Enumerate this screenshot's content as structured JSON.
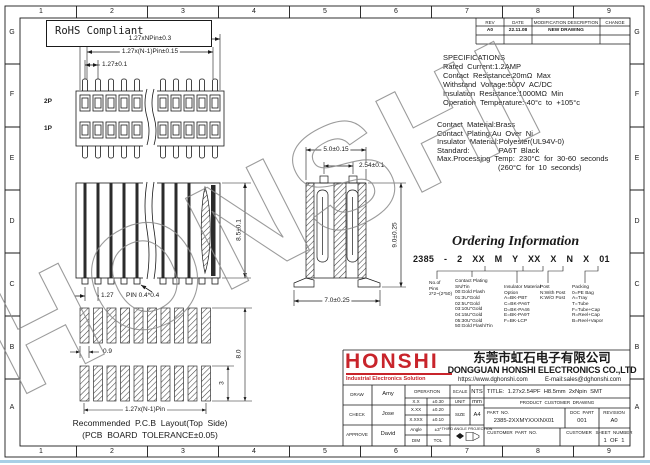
{
  "watermark": "HONSHI",
  "rohs": "RoHS Compliant",
  "grid": {
    "cols": [
      "1",
      "2",
      "3",
      "4",
      "5",
      "6",
      "7",
      "8",
      "9"
    ],
    "rows": [
      "G",
      "F",
      "E",
      "D",
      "C",
      "B",
      "A"
    ]
  },
  "rev": {
    "h": [
      "REV",
      "DATE",
      "MODIFICATION DESCRIPTION",
      "CHANGE"
    ],
    "r": [
      "A0",
      "22.11.08",
      "NEW DRAWING"
    ]
  },
  "spec": {
    "title": "SPECIFICATIONS",
    "lines": [
      "Rated  Current:1.2AMP",
      "Contact  Resistance:20mΩ  Max",
      "Withstand  Voltage:500V  AC/DC",
      "Insulation  Resistance:1000MΩ  Min",
      "Operation  Temperature:-40°c  to  +105°c"
    ]
  },
  "mat": {
    "lines": [
      "Contact  Material:Brass",
      "Contact  Plating:Au  Over  Ni",
      "Insulator  Material:Polyester(UL94V-0)",
      "Standard:              PA6T  Black",
      "Max.Processing  Temp:  230°C  for  30-60  seconds",
      "(260°C  for  10  seconds)"
    ]
  },
  "ord": {
    "title": "Ordering Information",
    "code": "2385 - 2 XX M Y XX X N X 01",
    "pins": "No.of\nPins\n2*2~(2*50)",
    "plating": "Contact Plating\nSN/Tin\n00:Gold Flash\n01:3U\"Gold\n02:5U\"Gold\n03:10U\"Gold\n04:15U\"Gold\n05:30U\"Gold\n50:Gold Flash/Tin",
    "insulator": "Insulator Material\nOption\nA=BK-PBT\nC=BK-PA6T\nD=BK-PA46\nE=BK-PA9T\nF=BK-LCP",
    "post": "Post\nN:With Post\nK:W/O Post",
    "packing": "Packing\n0=PE Bag\nA=Tray\nT=Tube\nF=Tube+Cap\nR=Reel+Cap\nB=Reel+Vapor"
  },
  "dims": {
    "front_overall": "1.27xNPin±0.3",
    "front_n1": "1.27x(N-1)Pin±0.15",
    "front_pitch": "1.27±0.1",
    "row2": "2P",
    "row1": "1P",
    "height": "8.5±0.1",
    "pitch127": "1.27",
    "pin_size": "PIN 0.4*0.4",
    "sec_width": "5.0±0.15",
    "sec_pitch": "2.54±0.1",
    "sec_height": "9.0±0.25",
    "sec_foot": "7.0±0.25",
    "pad_w": "0.9",
    "pad_span": "8.0",
    "pad_h": "3",
    "pcb_pitch": "1.27x(N-1)Pin",
    "pcb_caption1": "Recommended  P.C.B  Layout(Top  Side)",
    "pcb_caption2": "(PCB  BOARD  TOLERANCE±0.05)"
  },
  "co": {
    "logo": "HONSHI",
    "tagline": "Industrial Electronics Solution",
    "name_cn": "东莞市虹石电子有限公司",
    "name_en": "DONGGUAN HONSHI ELECTRONICS CO.,LTD",
    "web": "https://www.dghonshi.com",
    "email": "E-mail:sales@dghonshi.com"
  },
  "tb": {
    "draw_label": "DRAW",
    "draw": "Amy",
    "check_label": "CHECK",
    "check": "Jose",
    "approve_label": "APPROVE",
    "approve": "David",
    "operation_label": "OPERATION",
    "tol": [
      {
        "k": "X.X",
        "v": "±0.30"
      },
      {
        "k": "X.XX",
        "v": "±0.20"
      },
      {
        "k": "X.XXX",
        "v": "±0.10"
      },
      {
        "k": "Angle",
        "v": "±3°"
      },
      {
        "k": "DIM",
        "v": "TOL"
      }
    ],
    "scale_label": "SCALE",
    "scale": "NTS",
    "unit_label": "UNIT",
    "unit": "mm",
    "size_label": "SIZE",
    "size": "A4",
    "projection_label": "THIRD ANGLE PROJECTION",
    "title": "TITLE:  1.27x2.54PF  H8.5mm  2xNpin  SMT",
    "product": "PRODUCT  CUSTOMER  DRAWING",
    "part_no_label": "PART  NO.",
    "part_no": "2385-2XXMYXXXNX01",
    "doc_part_label": "DOC  PART",
    "doc_part": "001",
    "revision_label": "REVISION",
    "revision": "A0",
    "customer_part_label": "CUSTOMER  PART  NO.",
    "customer_label": "CUSTOMER",
    "sheet_label": "SHEET  NUMBER",
    "sheet": "1  OF  1"
  }
}
